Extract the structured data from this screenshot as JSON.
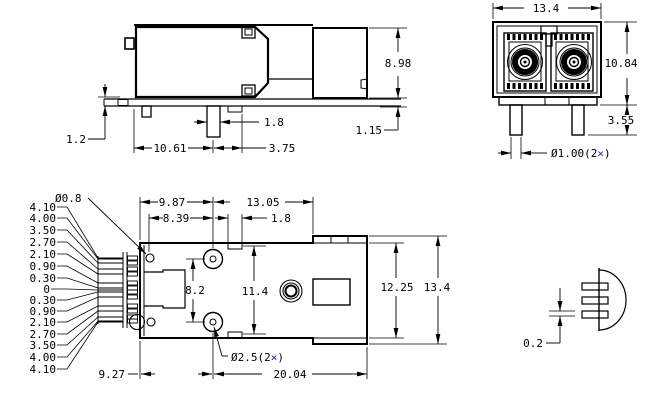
{
  "meta": {
    "background": "#ffffff",
    "line_color": "#000000",
    "times_color": "#2222bb"
  },
  "side_view": {
    "height": "8.98",
    "peg_width": "1.8",
    "standoff": "1.15",
    "board_offset": "1.2",
    "post_offset": "10.61",
    "post_to_step": "3.75"
  },
  "front_view": {
    "width": "13.4",
    "height": "10.84",
    "leg_length": "3.55",
    "leg_dia_prefix": "Ø1.00(2"
  },
  "top_view": {
    "hole_dia": "Ø0.8",
    "span_top_left": "9.87",
    "span_top_right": "13.05",
    "span_hole_to_post": "8.39",
    "slot_width": "1.8",
    "post_spacing": "8.2",
    "inner_height": "11.4",
    "body_height": "12.25",
    "overall_height": "13.4",
    "post_dia_prefix": "Ø2.5(2",
    "span_bottom_left": "9.27",
    "span_bottom_right": "20.04",
    "pin_labels": [
      "4.10",
      "4.00",
      "3.50",
      "2.70",
      "2.10",
      "0.90",
      "0.30",
      "0",
      "0.30",
      "0.90",
      "2.10",
      "2.70",
      "3.50",
      "4.00",
      "4.10"
    ]
  },
  "end_view": {
    "pin_thickness": "0.2"
  },
  "shared": {
    "times": "×",
    "close_paren": ")"
  }
}
